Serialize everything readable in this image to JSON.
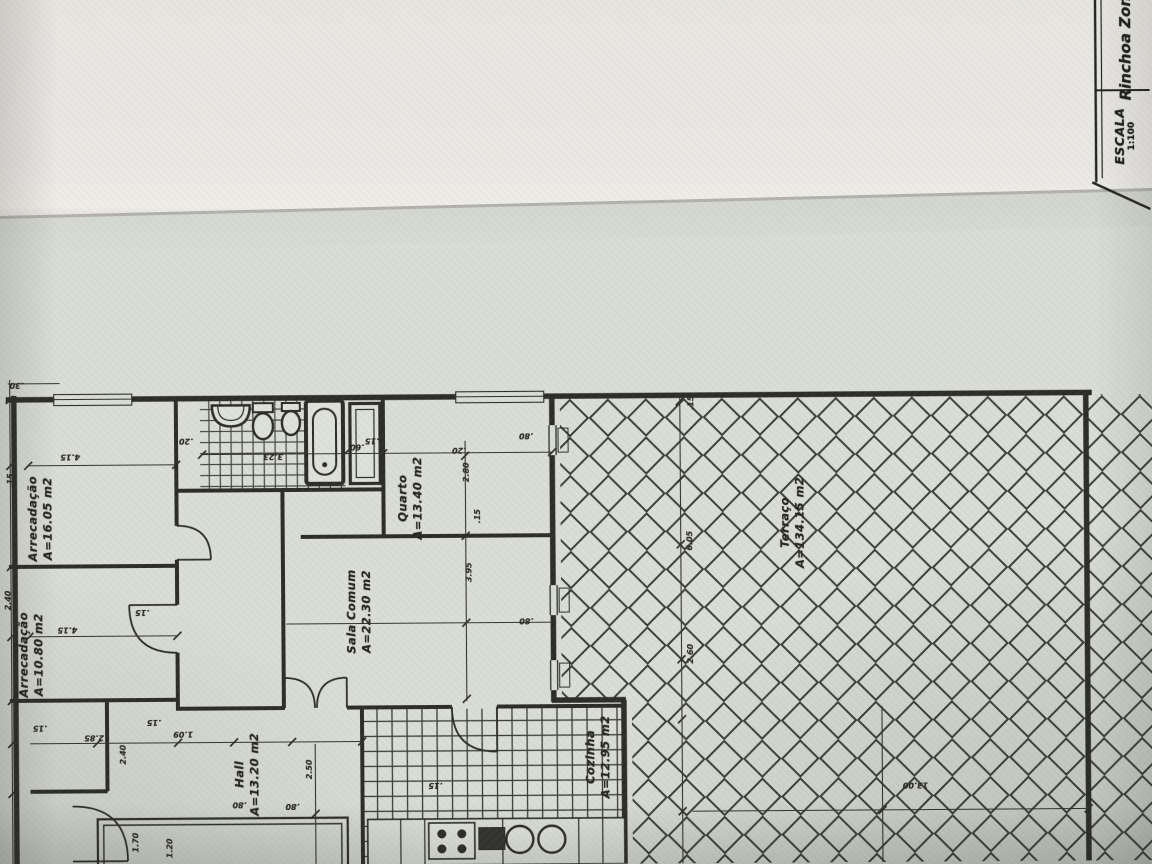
{
  "document": {
    "kind": "scanned floor plan photograph",
    "orientation_note": "all drawing text rotated 90°"
  },
  "title_block": {
    "zone": "Rinchoa Zona",
    "scale_label": "ESCALA",
    "scale_value": "1:100"
  },
  "rooms": [
    {
      "id": "arrecadacao-1",
      "name": "Arrecadação",
      "area": "A=16.05 m2",
      "cx": 40,
      "cy": 515
    },
    {
      "id": "arrecadacao-2",
      "name": "Arrecadação",
      "area": "A=10.80 m2",
      "cx": 30,
      "cy": 651
    },
    {
      "id": "quarto",
      "name": "Quarto",
      "area": "A=13.40 m2",
      "cx": 410,
      "cy": 497
    },
    {
      "id": "sala-comum",
      "name": "Sala Comum",
      "area": "A=22.30 m2",
      "cx": 358,
      "cy": 610
    },
    {
      "id": "hall",
      "name": "Hall",
      "area": "A=13.20 m2",
      "cx": 245,
      "cy": 772
    },
    {
      "id": "cozinha",
      "name": "Cozinha",
      "area": "A=12.95 m2",
      "cx": 596,
      "cy": 757
    },
    {
      "id": "terraco",
      "name": "Terraço",
      "area": "A=134.15 m2",
      "cx": 792,
      "cy": 524
    }
  ],
  "dimensions": [
    {
      "v": ".30",
      "x": 17,
      "y": 383,
      "r": 180
    },
    {
      "v": "4.15",
      "x": 70,
      "y": 455,
      "r": 180
    },
    {
      "v": ".15",
      "x": 10,
      "y": 478,
      "r": -90
    },
    {
      "v": "2.40",
      "x": 7,
      "y": 598,
      "r": -90
    },
    {
      "v": "4.15",
      "x": 66,
      "y": 628,
      "r": 180
    },
    {
      "v": ".15",
      "x": 141,
      "y": 611,
      "r": 180
    },
    {
      "v": ".20",
      "x": 186,
      "y": 440,
      "r": 180
    },
    {
      "v": "3.23",
      "x": 273,
      "y": 456,
      "r": 180
    },
    {
      "v": ".60",
      "x": 357,
      "y": 447,
      "r": 180
    },
    {
      "v": ".15",
      "x": 372,
      "y": 441,
      "r": 180
    },
    {
      "v": ".20",
      "x": 459,
      "y": 451,
      "r": 180
    },
    {
      "v": "2.80",
      "x": 466,
      "y": 473,
      "r": -90
    },
    {
      "v": ".15",
      "x": 477,
      "y": 517,
      "r": -90
    },
    {
      "v": "3.95",
      "x": 468,
      "y": 573,
      "r": -90
    },
    {
      "v": ".80",
      "x": 526,
      "y": 437,
      "r": 180
    },
    {
      "v": ".80",
      "x": 525,
      "y": 622,
      "r": 180
    },
    {
      "v": ".15",
      "x": 152,
      "y": 721,
      "r": 180
    },
    {
      "v": "1.09",
      "x": 181,
      "y": 733,
      "r": 180
    },
    {
      "v": ".15",
      "x": 38,
      "y": 726,
      "r": 180
    },
    {
      "v": "2.85",
      "x": 92,
      "y": 736,
      "r": 180
    },
    {
      "v": "2.40",
      "x": 121,
      "y": 753,
      "r": -90
    },
    {
      "v": "1.70",
      "x": 133,
      "y": 841,
      "r": -90
    },
    {
      "v": "1.20",
      "x": 167,
      "y": 847,
      "r": -90
    },
    {
      "v": "2.50",
      "x": 307,
      "y": 769,
      "r": -90
    },
    {
      "v": ".80",
      "x": 237,
      "y": 804,
      "r": 180
    },
    {
      "v": ".80",
      "x": 290,
      "y": 806,
      "r": 180
    },
    {
      "v": ".15",
      "x": 433,
      "y": 786,
      "r": 180
    },
    {
      "v": ".15",
      "x": 691,
      "y": 405,
      "r": -90
    },
    {
      "v": "6.05",
      "x": 689,
      "y": 543,
      "r": -90
    },
    {
      "v": "2.60",
      "x": 689,
      "y": 656,
      "r": -90
    },
    {
      "v": "13.00",
      "x": 913,
      "y": 789,
      "r": 180
    }
  ],
  "colors": {
    "paper_bright": "#eae8e3",
    "paper_main": "#d9ddd5",
    "ink": "#2c2d28",
    "crease": "#b2b1ad"
  }
}
